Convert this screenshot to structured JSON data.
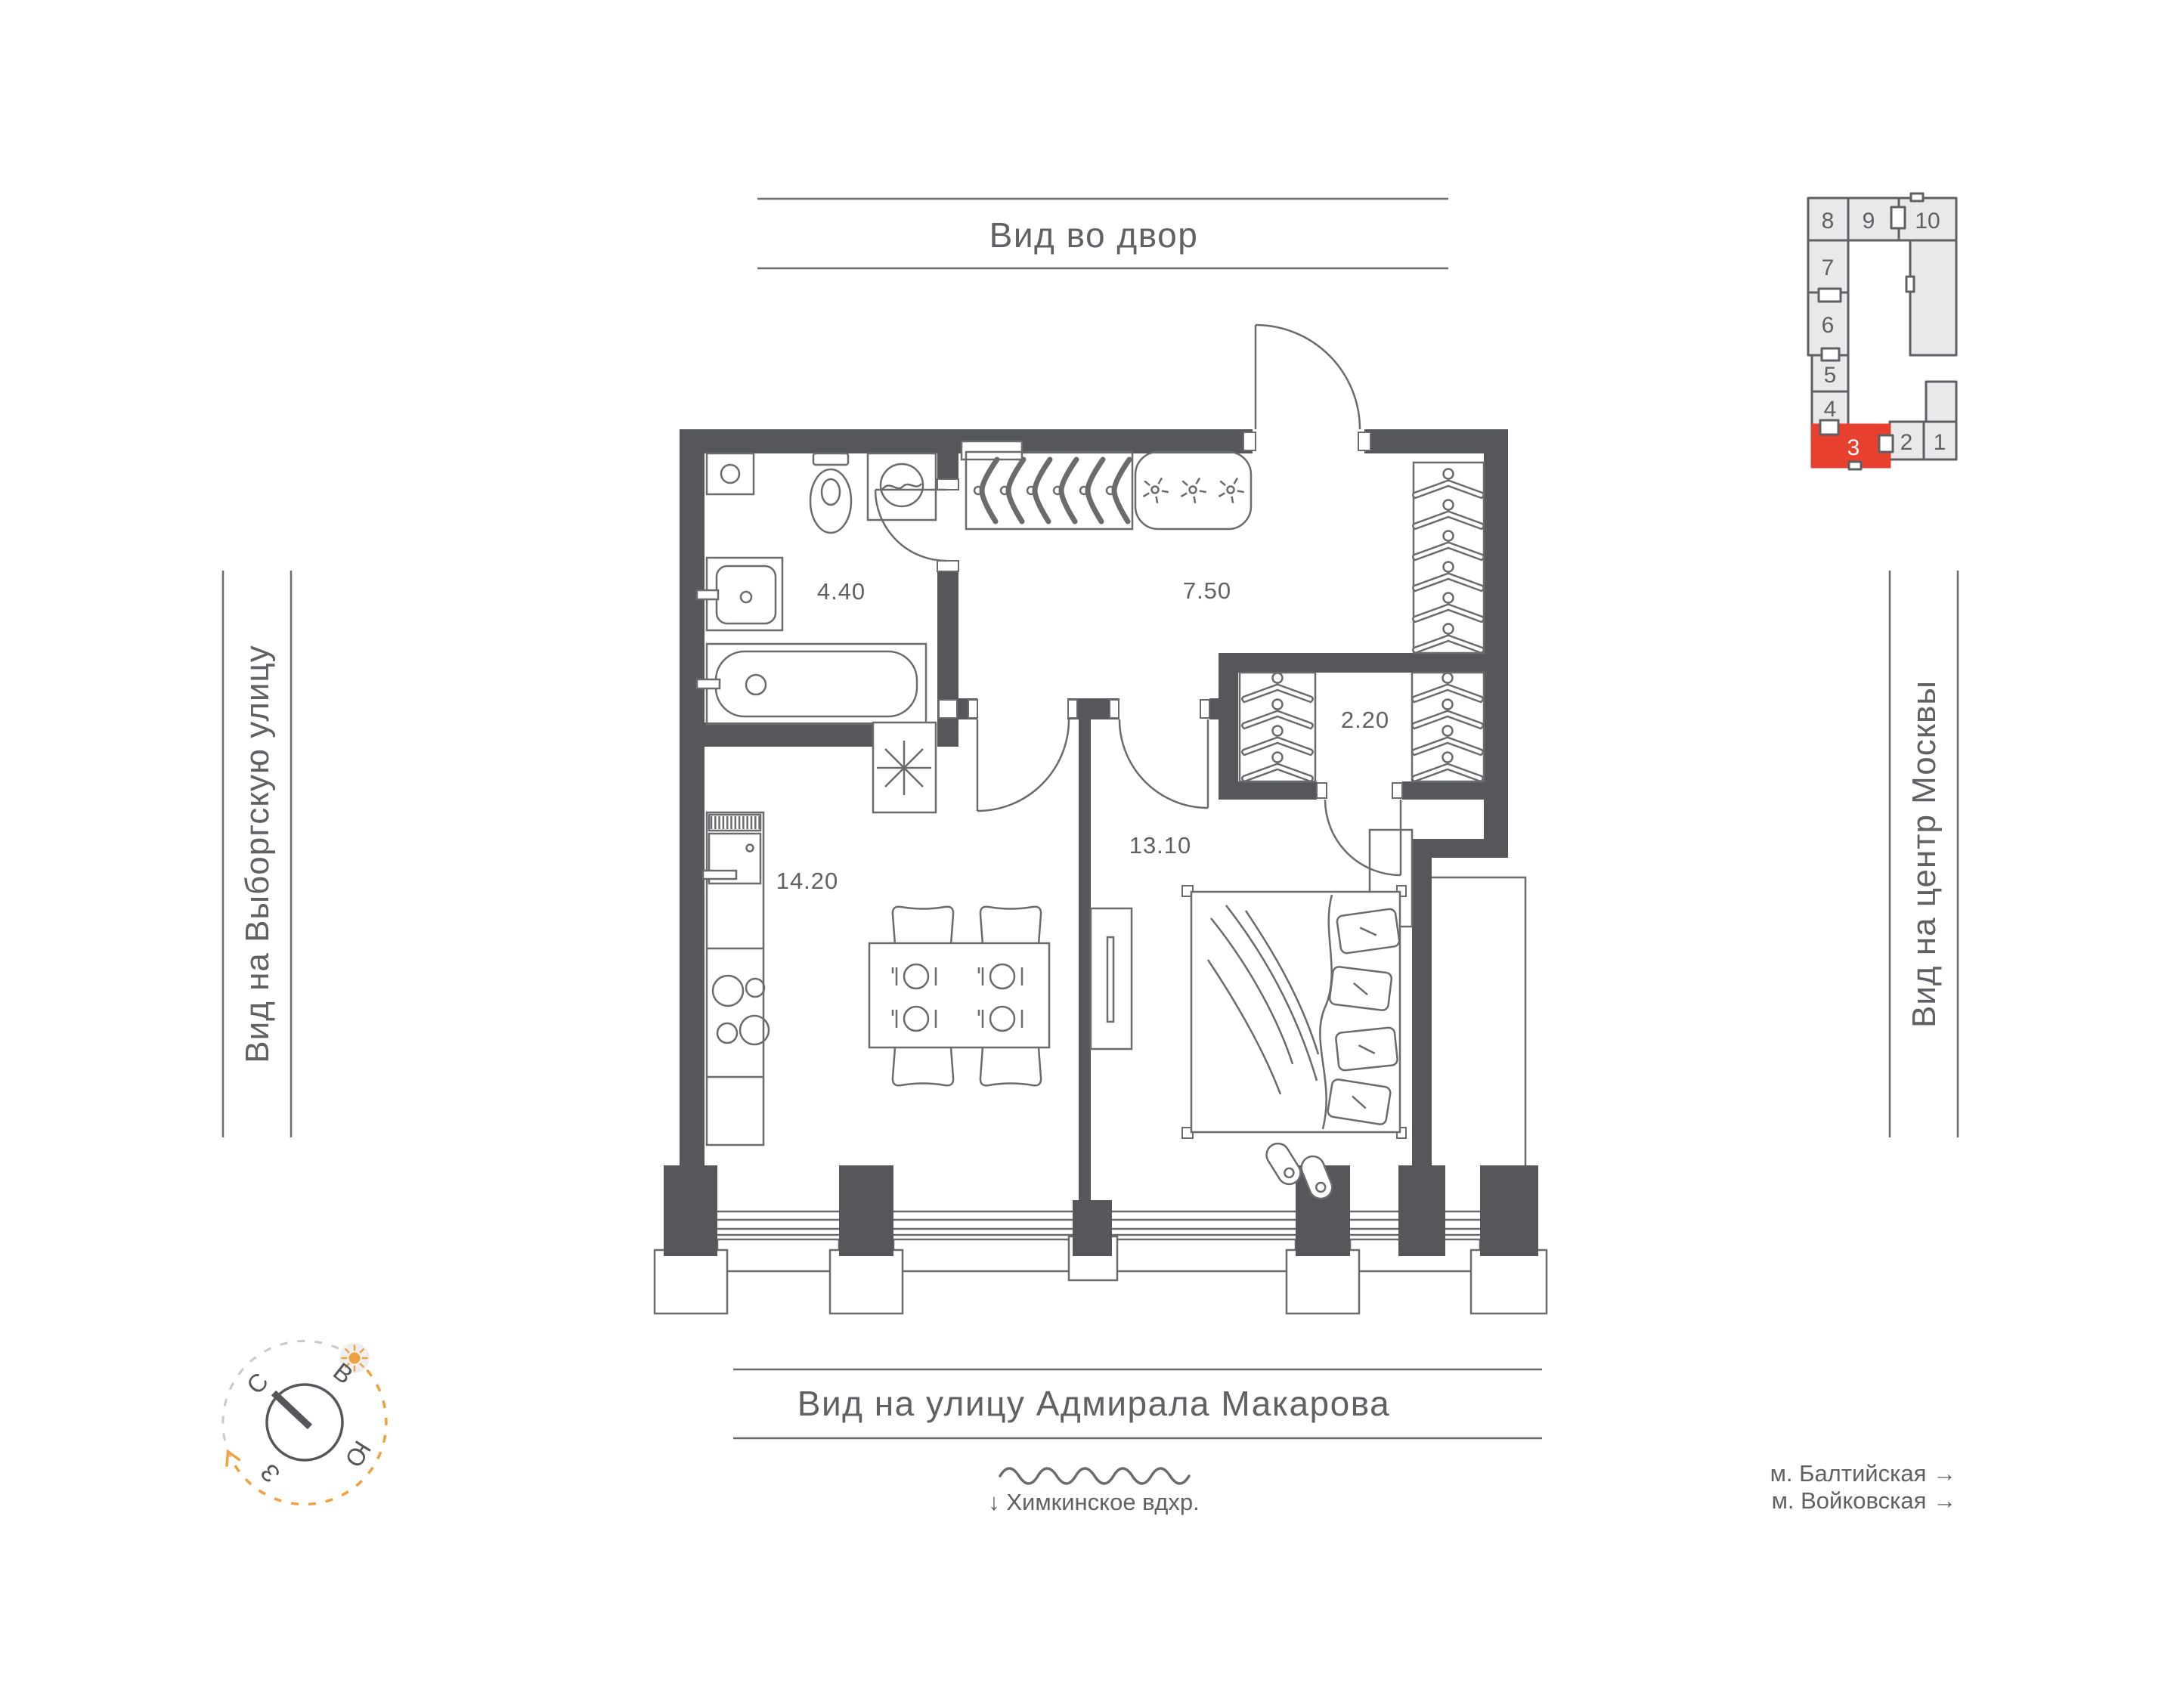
{
  "labels": {
    "view_top": "Вид во двор",
    "view_left": "Вид на Выборгскую улицу",
    "view_right": "Вид на центр Москвы",
    "view_bottom": "Вид на улицу Адмирала Макарова",
    "water_line": "↓  Химкинское вдхр.",
    "metro_1": "м. Балтийская  →",
    "metro_2": "м. Войковская  →"
  },
  "rooms": {
    "bathroom": "4.40",
    "hallway": "7.50",
    "closet": "2.20",
    "kitchen": "14.20",
    "bedroom": "13.10"
  },
  "mini_plan": {
    "units": [
      "1",
      "2",
      "3",
      "4",
      "5",
      "6",
      "7",
      "8",
      "9",
      "10"
    ],
    "highlighted": "3"
  },
  "compass": {
    "north": "С",
    "east": "В",
    "south": "Ю",
    "west": "З"
  },
  "colors": {
    "wall": "#56575B",
    "line": "#6A6B6F",
    "text": "#606065",
    "red": "#E8402F",
    "orange": "#F0A03C",
    "mini_fill": "#E9E9EB",
    "mini_stroke": "#5F6064"
  },
  "furniture": {
    "hall_hangers": 6,
    "closet_left_hangers": 4,
    "closet_right_hangers": 4,
    "shoes": 6,
    "lamps": 3,
    "place_settings": 4,
    "chairs": 4,
    "pillows": 4,
    "slippers": 2
  }
}
